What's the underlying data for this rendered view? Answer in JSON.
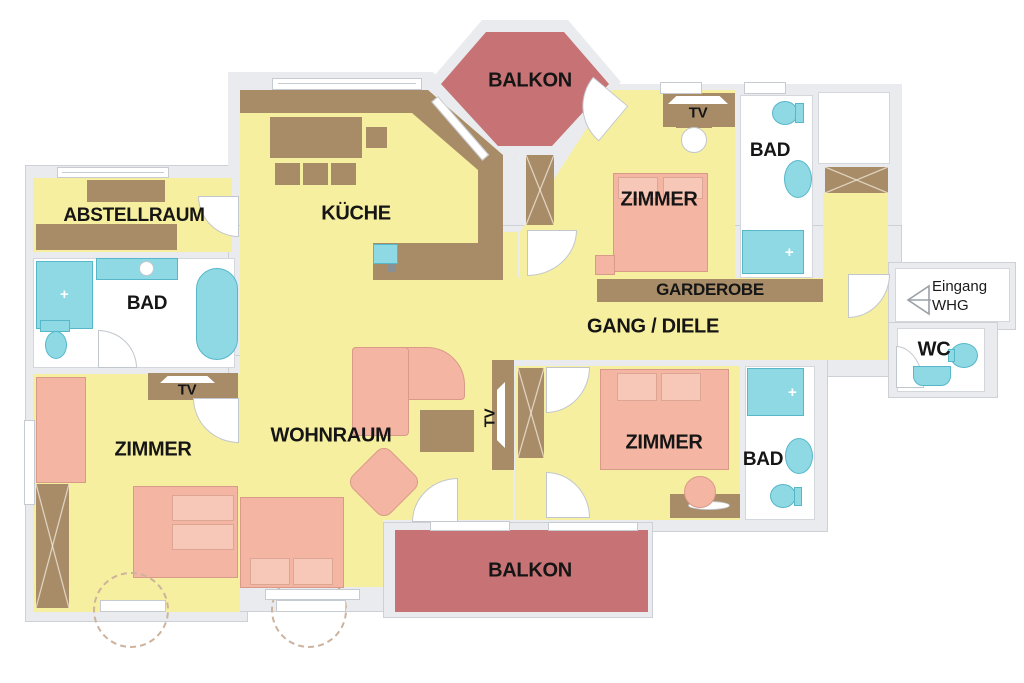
{
  "title": "Apartment floor plan (WHG)",
  "labels": {
    "balkon": "BALKON",
    "kueche": "KÜCHE",
    "abstellraum": "ABSTELLRAUM",
    "bad": "BAD",
    "zimmer": "ZIMMER",
    "tv": "TV",
    "garderobe": "GARDEROBE",
    "gang_diele": "GANG / DIELE",
    "wohnraum": "WOHNRAUM",
    "wc": "WC",
    "eingang_line1": "Eingang",
    "eingang_line2": "WHG"
  },
  "colors": {
    "floor_yellow": "#f6ef9f",
    "furniture_brown": "#a88c68",
    "bed_sofa_pink": "#f4b5a3",
    "sanitary_cyan": "#8fd9e5",
    "balcony_red": "#c77274",
    "wall_gray": "#e9ebee",
    "wall_line": "#c6cbd1",
    "room_white": "#ffffff",
    "text": "#151515"
  }
}
